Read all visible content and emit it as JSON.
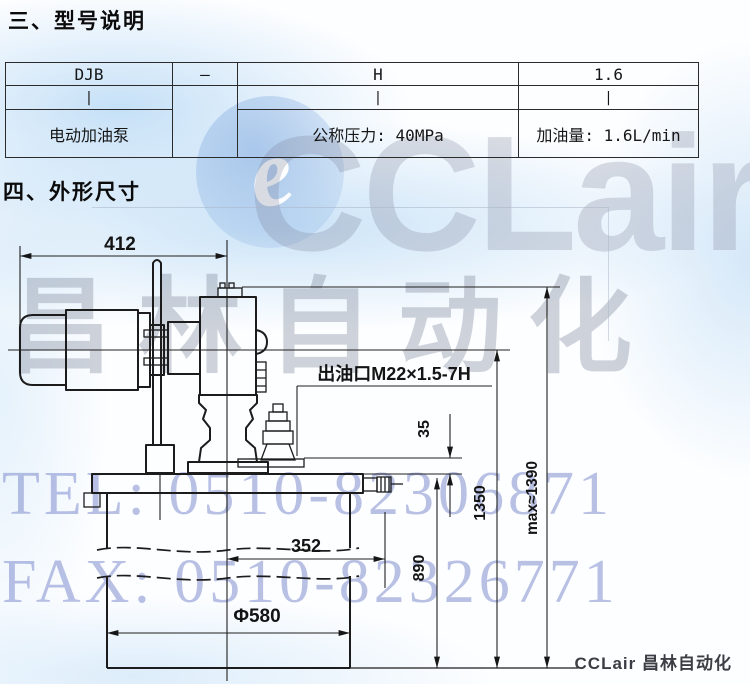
{
  "header": {
    "section_model": "三、型号说明",
    "section_dims": "四、外形尺寸"
  },
  "model_table": {
    "codes": [
      "DJB",
      "—",
      "H",
      "1.6"
    ],
    "connector": "|",
    "meanings": {
      "pump": "电动加油泵",
      "pressure": "公称压力: 40MPa",
      "flow": "加油量: 1.6L/min"
    }
  },
  "drawing": {
    "dim_412": "412",
    "outlet_label": "出油口M22×1.5-7H",
    "dim_35": "35",
    "dim_352": "352",
    "dia_580": "Φ580",
    "dim_890": "890",
    "dim_1350": "1350",
    "dim_max1390": "max≈1390"
  },
  "watermark": {
    "logo_letter": "e",
    "logo_text": "CCLair",
    "brand_cn": "昌林自动化",
    "tel": "TEL: 0510-82306871",
    "fax": "FAX: 0510-82326771"
  },
  "footer": {
    "brand": "CCLair 昌林自动化"
  },
  "colors": {
    "line": "#1c1c1c",
    "watermark_blue": "#808ccd",
    "watermark_gray": "#b9bdc8",
    "wash_blue": "#cfe3f4"
  }
}
